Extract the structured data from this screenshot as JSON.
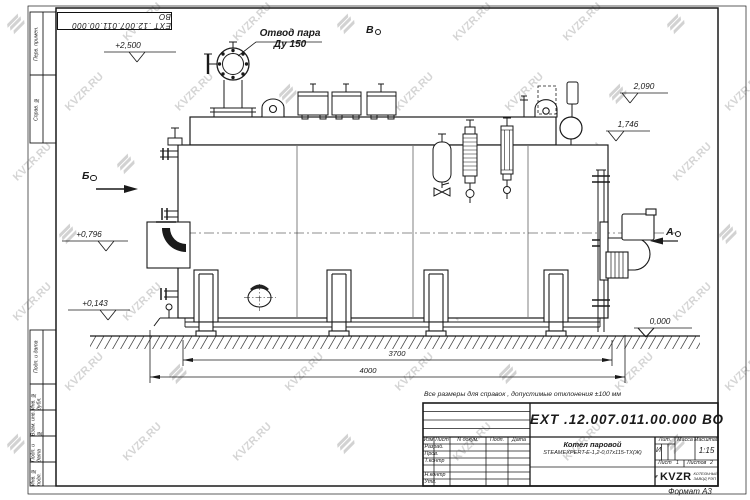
{
  "watermark": {
    "text": "KVZR.RU"
  },
  "stamp_top": {
    "text": "ЕХТ .12.007.011.00.000  ВО"
  },
  "callout": {
    "line1": "Отвод пара",
    "line2": "Ду 150"
  },
  "view_markers": {
    "a": "А",
    "b": "Б",
    "v": "В"
  },
  "levels": {
    "l2500": "+2,500",
    "l2090": "2,090",
    "l1746": "1,746",
    "l0796": "+0,796",
    "l0143": "+0,143",
    "l0000": "0,000"
  },
  "dimensions": {
    "d3700": "3700",
    "d4000": "4000"
  },
  "note": "Все размеры для справок , допустимые отклонения  ±100  мм",
  "margin": {
    "labels": [
      "Перв. примен.",
      "Справ. №",
      "Подп. и дата",
      "Инв. № дубл.",
      "Взам. инв. №",
      "Подп. и дата",
      "Инв. № подл."
    ]
  },
  "titleblock": {
    "doc_number": "ЕХТ .12.007.011.00.000  ВО",
    "product_line1": "Котел паровой",
    "product_line2": "STEAMEXPERT-Е-1,2-0,07х115-ТХ(Ж)",
    "headers": {
      "izm": "Изм",
      "list": "Лист",
      "ndokum": "N докум.",
      "podp": "Подп.",
      "data": "Дата"
    },
    "roles": [
      "Разраб.",
      "Пров.",
      "Т.контр",
      "Н.контр",
      "Утв."
    ],
    "lit_label": "Лит.",
    "lit_value": "И",
    "massa_label": "Масса",
    "masshtab_label": "Масштаб",
    "scale": "1:15",
    "sheet_label": "Лист",
    "sheet_value": "1",
    "sheets_label": "Листов",
    "sheets_value": "2",
    "logo_text": "KVZR",
    "logo_sub1": "КОТЕЛЬНЫЙ",
    "logo_sub2": "ЗАВОД РЭП",
    "format_label": "Формат А3"
  }
}
